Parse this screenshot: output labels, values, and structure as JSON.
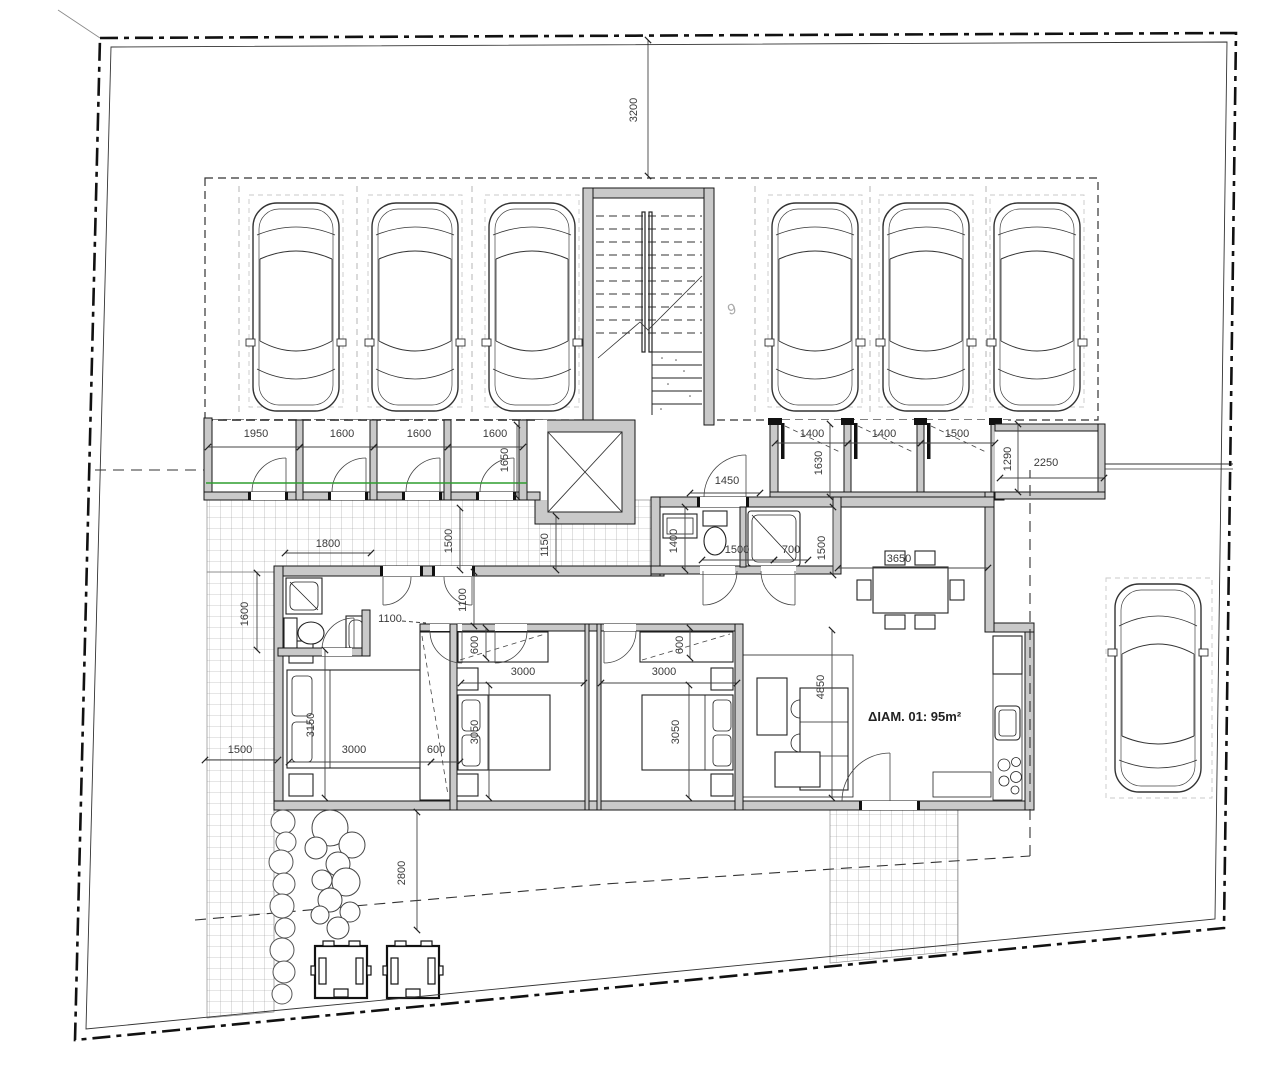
{
  "labels": {
    "apartment": "ΔΙΑΜ. 01: 95m²",
    "parking_space": "9"
  },
  "colors": {
    "walls": "#c9c9c9",
    "boundary": "#111111",
    "utility_line_green": "#2f9e2f",
    "tile_grid": "#9a9a9a",
    "dim_text": "#3a3a3a"
  },
  "dim_labels": [
    {
      "t": "3200",
      "x": 637,
      "y": 110,
      "r": -90
    },
    {
      "t": "1950",
      "x": 256,
      "y": 437,
      "r": 0
    },
    {
      "t": "1600",
      "x": 342,
      "y": 437,
      "r": 0
    },
    {
      "t": "1600",
      "x": 419,
      "y": 437,
      "r": 0
    },
    {
      "t": "1600",
      "x": 495,
      "y": 437,
      "r": 0
    },
    {
      "t": "1650",
      "x": 508,
      "y": 460,
      "r": -90
    },
    {
      "t": "1400",
      "x": 812,
      "y": 437,
      "r": 0
    },
    {
      "t": "1400",
      "x": 884,
      "y": 437,
      "r": 0
    },
    {
      "t": "1500",
      "x": 957,
      "y": 437,
      "r": 0
    },
    {
      "t": "1630",
      "x": 822,
      "y": 463,
      "r": -90
    },
    {
      "t": "1290",
      "x": 1011,
      "y": 459,
      "r": -90
    },
    {
      "t": "2250",
      "x": 1046,
      "y": 466,
      "r": 0
    },
    {
      "t": "1450",
      "x": 727,
      "y": 484,
      "r": 0
    },
    {
      "t": "1800",
      "x": 328,
      "y": 547,
      "r": 0
    },
    {
      "t": "1500",
      "x": 452,
      "y": 541,
      "r": -90
    },
    {
      "t": "1150",
      "x": 548,
      "y": 545,
      "r": -90
    },
    {
      "t": "1400",
      "x": 677,
      "y": 541,
      "r": -90
    },
    {
      "t": "1500",
      "x": 737,
      "y": 553,
      "r": 0
    },
    {
      "t": "700",
      "x": 791,
      "y": 553,
      "r": 0
    },
    {
      "t": "1500",
      "x": 825,
      "y": 548,
      "r": -90
    },
    {
      "t": "3650",
      "x": 899,
      "y": 562,
      "r": 0
    },
    {
      "t": "1600",
      "x": 248,
      "y": 614,
      "r": -90
    },
    {
      "t": "1100",
      "x": 390,
      "y": 622,
      "r": 0
    },
    {
      "t": "1100",
      "x": 466,
      "y": 600,
      "r": -90
    },
    {
      "t": "600",
      "x": 478,
      "y": 645,
      "r": -90
    },
    {
      "t": "3000",
      "x": 523,
      "y": 675,
      "r": 0
    },
    {
      "t": "3050",
      "x": 478,
      "y": 732,
      "r": -90
    },
    {
      "t": "600",
      "x": 683,
      "y": 645,
      "r": -90
    },
    {
      "t": "3000",
      "x": 664,
      "y": 675,
      "r": 0
    },
    {
      "t": "3050",
      "x": 679,
      "y": 732,
      "r": -90
    },
    {
      "t": "3150",
      "x": 314,
      "y": 725,
      "r": -90
    },
    {
      "t": "3000",
      "x": 354,
      "y": 753,
      "r": 0
    },
    {
      "t": "600",
      "x": 436,
      "y": 753,
      "r": 0
    },
    {
      "t": "4850",
      "x": 824,
      "y": 687,
      "r": -90
    },
    {
      "t": "1500",
      "x": 240,
      "y": 753,
      "r": 0
    },
    {
      "t": "2800",
      "x": 405,
      "y": 873,
      "r": -90
    }
  ]
}
